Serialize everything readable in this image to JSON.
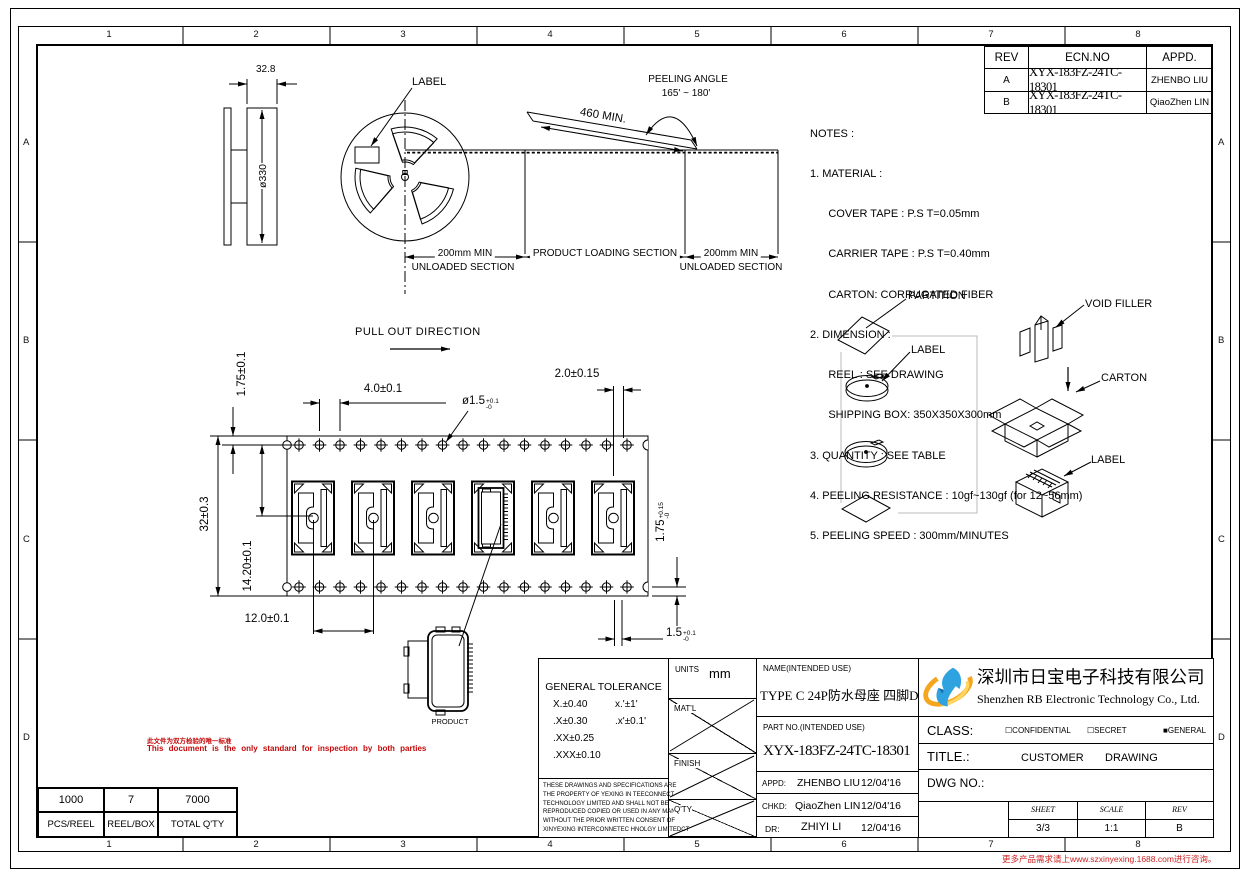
{
  "frame": {
    "zone_cols": [
      "1",
      "2",
      "3",
      "4",
      "5",
      "6",
      "7",
      "8"
    ],
    "zone_rows": [
      "A",
      "B",
      "C",
      "D"
    ],
    "footer_note": "更多产品需求请上www.szxinyexing.1688.com进行咨询。"
  },
  "rev_table": {
    "col_rev": "REV",
    "col_ecn": "ECN.NO",
    "col_appd": "APPD.",
    "rows": [
      {
        "rev": "A",
        "ecn": "XYX-183FZ-24TC-18301",
        "appd": "ZHENBO LIU"
      },
      {
        "rev": "B",
        "ecn": "XYX-183FZ-24TC-18301",
        "appd": "QiaoZhen LIN"
      }
    ]
  },
  "notes": {
    "title": "NOTES :",
    "lines": [
      "1. MATERIAL :",
      "      COVER TAPE : P.S T=0.05mm",
      "      CARRIER TAPE : P.S T=0.40mm",
      "      CARTON: CORRUGATED FIBER",
      "2. DIMENSION :",
      "      REEL : SEE DRAWING",
      "      SHIPPING BOX: 350X350X300mm",
      "3. QUANTITY : SEE TABLE",
      "4. PEELING RESISTANCE : 10gf~130gf (for 12~56mm)",
      "5. PEELING SPEED : 300mm/MINUTES"
    ]
  },
  "reel": {
    "flange_width": "32.8",
    "diameter": "ø330",
    "label_callout": "LABEL"
  },
  "tape": {
    "peeling_angle_line1": "PEELING ANGLE",
    "peeling_angle_line2": "165' ~ 180'",
    "peel_length": "460 MIN.",
    "unloaded_dim_left": "200mm MIN",
    "unloaded_label_left": "UNLOADED SECTION",
    "loading_label": "PRODUCT LOADING SECTION",
    "unloaded_dim_right": "200mm MIN",
    "unloaded_label_right": "UNLOADED SECTION"
  },
  "carrier": {
    "pull_out": "PULL OUT DIRECTION",
    "dim_edge_to_hole": "1.75±0.1",
    "dim_hole_pitch": "4.0±0.1",
    "dim_hole_to_pocket": "2.0±0.15",
    "hole_dia_main": "ø1.5",
    "hole_dia_sup": "+0.1",
    "hole_dia_sub": "-0",
    "dim_tape_width": "32±0.3",
    "dim_hole_to_center": "14.20±0.1",
    "dim_pocket_pitch": "12.0±0.1",
    "dim_bottom_main": "1.75",
    "dim_bottom_sup": "+0.15",
    "dim_bottom_sub": "-0",
    "dim_slot_main": "1.5",
    "dim_slot_sup": "+0.1",
    "dim_slot_sub": "-0",
    "product_label": "PRODUCT"
  },
  "packaging": {
    "partition": "PARTITION",
    "reel_label": "LABEL",
    "void_filler": "VOID FILLER",
    "carton": "CARTON",
    "box_label": "LABEL"
  },
  "inspection": {
    "zh": "此文件为双方检验的唯一标准",
    "en": "This document is the only standard for inspection by both parties"
  },
  "qty_table": {
    "values": [
      "1000",
      "7",
      "7000"
    ],
    "labels": [
      "PCS/REEL",
      "REEL/BOX",
      "TOTAL Q'TY"
    ]
  },
  "title_block": {
    "tol_title": "GENERAL TOLERANCE",
    "tol_r1a": "X.±0.40",
    "tol_r1b": "x.'±1'",
    "tol_r2a": ".X±0.30",
    "tol_r2b": ".x'±0.1'",
    "tol_r3a": ".XX±0.25",
    "tol_r4a": ".XXX±0.10",
    "legal": [
      "THESE DRAWINGS AND SPECIFICATIONS ARE",
      "THE PROPERTY OF YEXING IN TEECONNECT",
      "TECHNOLOGY LIMITED AND SHALL NOT BE",
      "REPRODUCED COPIED OR USED IN ANY MANNER",
      "WITHOUT THE PRIOR WRITTEN CONSENT OF",
      "XINYEXING INTERCONNETEC HNOLGY LIMITEDCT"
    ],
    "units_label": "UNITS",
    "units_value": "mm",
    "matl_label": "MAT'L",
    "finish_label": "FINISH",
    "qty_label": "Q'TY",
    "name_label": "NAME(INTENDED USE)",
    "name_value": "TYPE C 24P防水母座 四脚DIP",
    "part_label": "PART NO.(INTENDED USE)",
    "part_value": "XYX-183FZ-24TC-18301",
    "appd_label": "APPD:",
    "appd_value": "ZHENBO LIU",
    "appd_date": "12/04'16",
    "chkd_label": "CHKD:",
    "chkd_value": "QiaoZhen LIN",
    "chkd_date": "12/04'16",
    "dr_label": "DR:",
    "dr_value": "ZHIYI LI",
    "dr_date": "12/04'16",
    "company_zh": "深圳市日宝电子科技有限公司",
    "company_en": "Shenzhen RB Electronic Technology Co., Ltd.",
    "class_label": "CLASS:",
    "class_opt1_box": "☐",
    "class_opt1": "CONFIDENTIAL",
    "class_opt2_box": "☐",
    "class_opt2": "SECRET",
    "class_opt3_box": "■",
    "class_opt3": "GENERAL",
    "title_label": "TITLE.:",
    "title_value1": "CUSTOMER",
    "title_value2": "DRAWING",
    "dwg_label": "DWG NO.:",
    "sheet_label": "SHEET",
    "sheet_value": "3/3",
    "scale_label": "SCALE",
    "scale_value": "1:1",
    "rev_label": "REV",
    "rev_value": "B"
  }
}
